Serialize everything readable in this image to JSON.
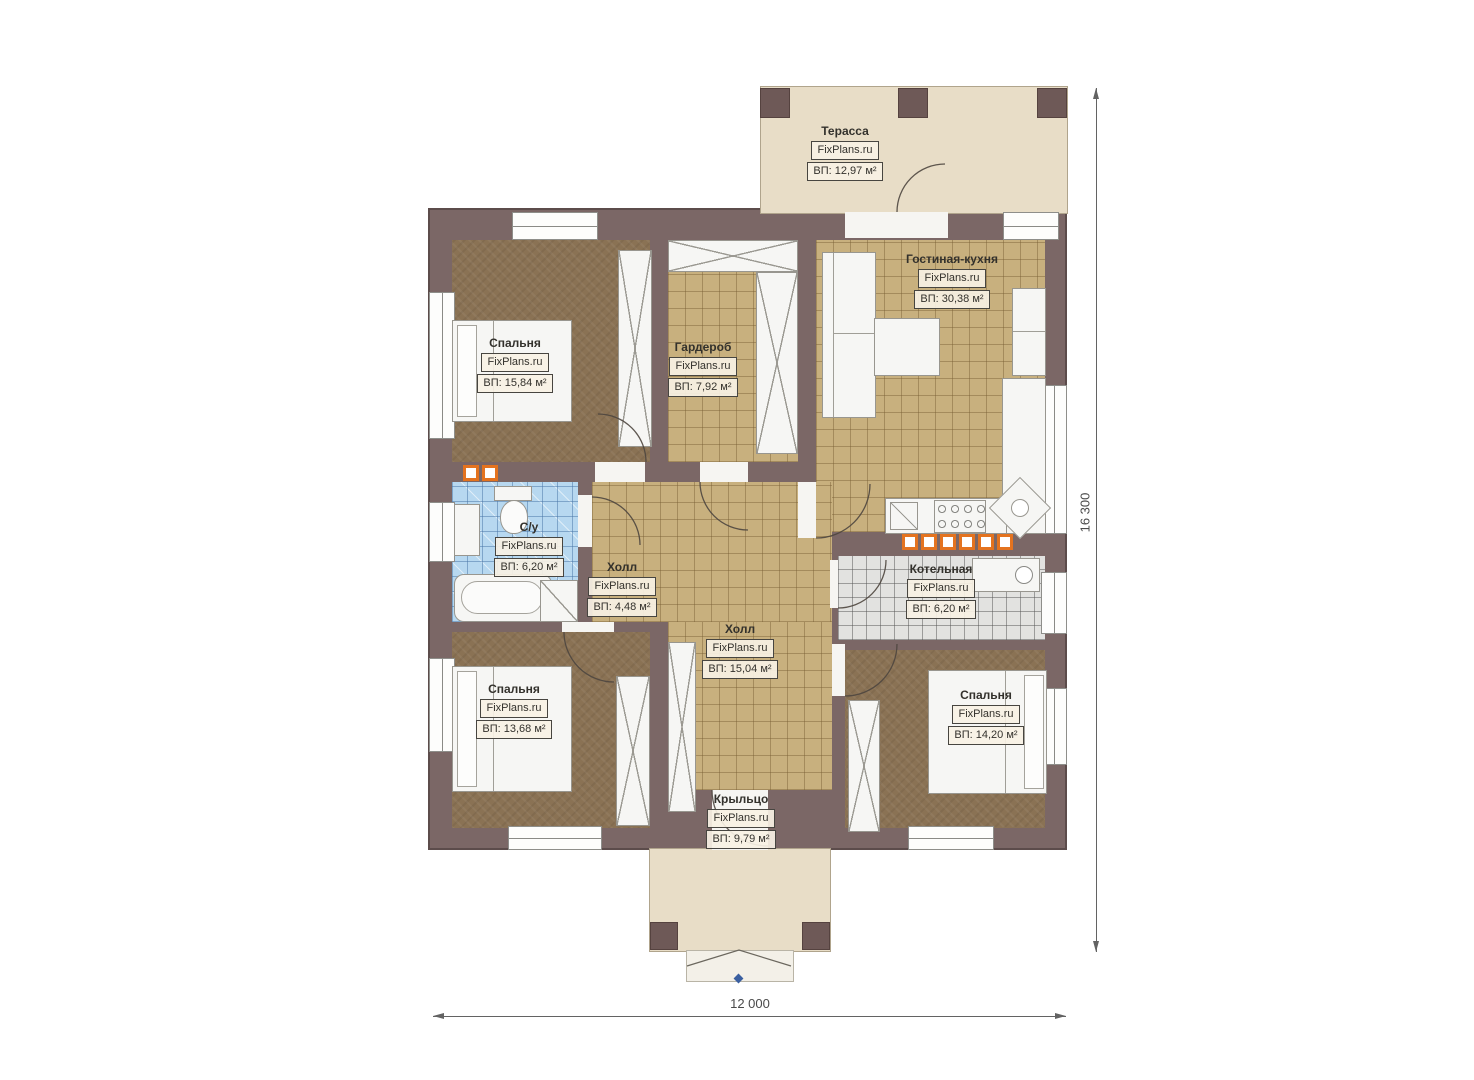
{
  "plan": {
    "title": "Floor plan",
    "brand": "FixPlans.ru",
    "rooms": [
      {
        "key": "terrace",
        "name": "Терасса",
        "brand": "FixPlans.ru",
        "area": "ВП: 12,97 м²"
      },
      {
        "key": "bedroom-tl",
        "name": "Спальня",
        "brand": "FixPlans.ru",
        "area": "ВП: 15,84 м²"
      },
      {
        "key": "wardrobe",
        "name": "Гардероб",
        "brand": "FixPlans.ru",
        "area": "ВП: 7,92 м²"
      },
      {
        "key": "living-kitchen",
        "name": "Гостиная-кухня",
        "brand": "FixPlans.ru",
        "area": "ВП: 30,38 м²"
      },
      {
        "key": "bathroom",
        "name": "С/у",
        "brand": "FixPlans.ru",
        "area": "ВП: 6,20 м²"
      },
      {
        "key": "hall-small",
        "name": "Холл",
        "brand": "FixPlans.ru",
        "area": "ВП: 4,48 м²"
      },
      {
        "key": "hall-main",
        "name": "Холл",
        "brand": "FixPlans.ru",
        "area": "ВП: 15,04 м²"
      },
      {
        "key": "boiler",
        "name": "Котельная",
        "brand": "FixPlans.ru",
        "area": "ВП: 6,20 м²"
      },
      {
        "key": "bedroom-bl",
        "name": "Спальня",
        "brand": "FixPlans.ru",
        "area": "ВП: 13,68 м²"
      },
      {
        "key": "bedroom-br",
        "name": "Спальня",
        "brand": "FixPlans.ru",
        "area": "ВП: 14,20 м²"
      },
      {
        "key": "porch",
        "name": "Крыльцо",
        "brand": "FixPlans.ru",
        "area": "ВП: 9,79 м²"
      }
    ],
    "dimensions": {
      "width": "12 000",
      "height": "16 300"
    },
    "colors": {
      "wall": "#7b6766",
      "accent_orange": "#e4731f",
      "tan_tile": "#c8b07e",
      "carpet": "#8a7254",
      "blue_tile": "#b7d8f0",
      "gray_tile": "#e2e2e0",
      "terrace_beige": "#e8ddc7",
      "marker_blue": "#3a5fa0"
    }
  }
}
